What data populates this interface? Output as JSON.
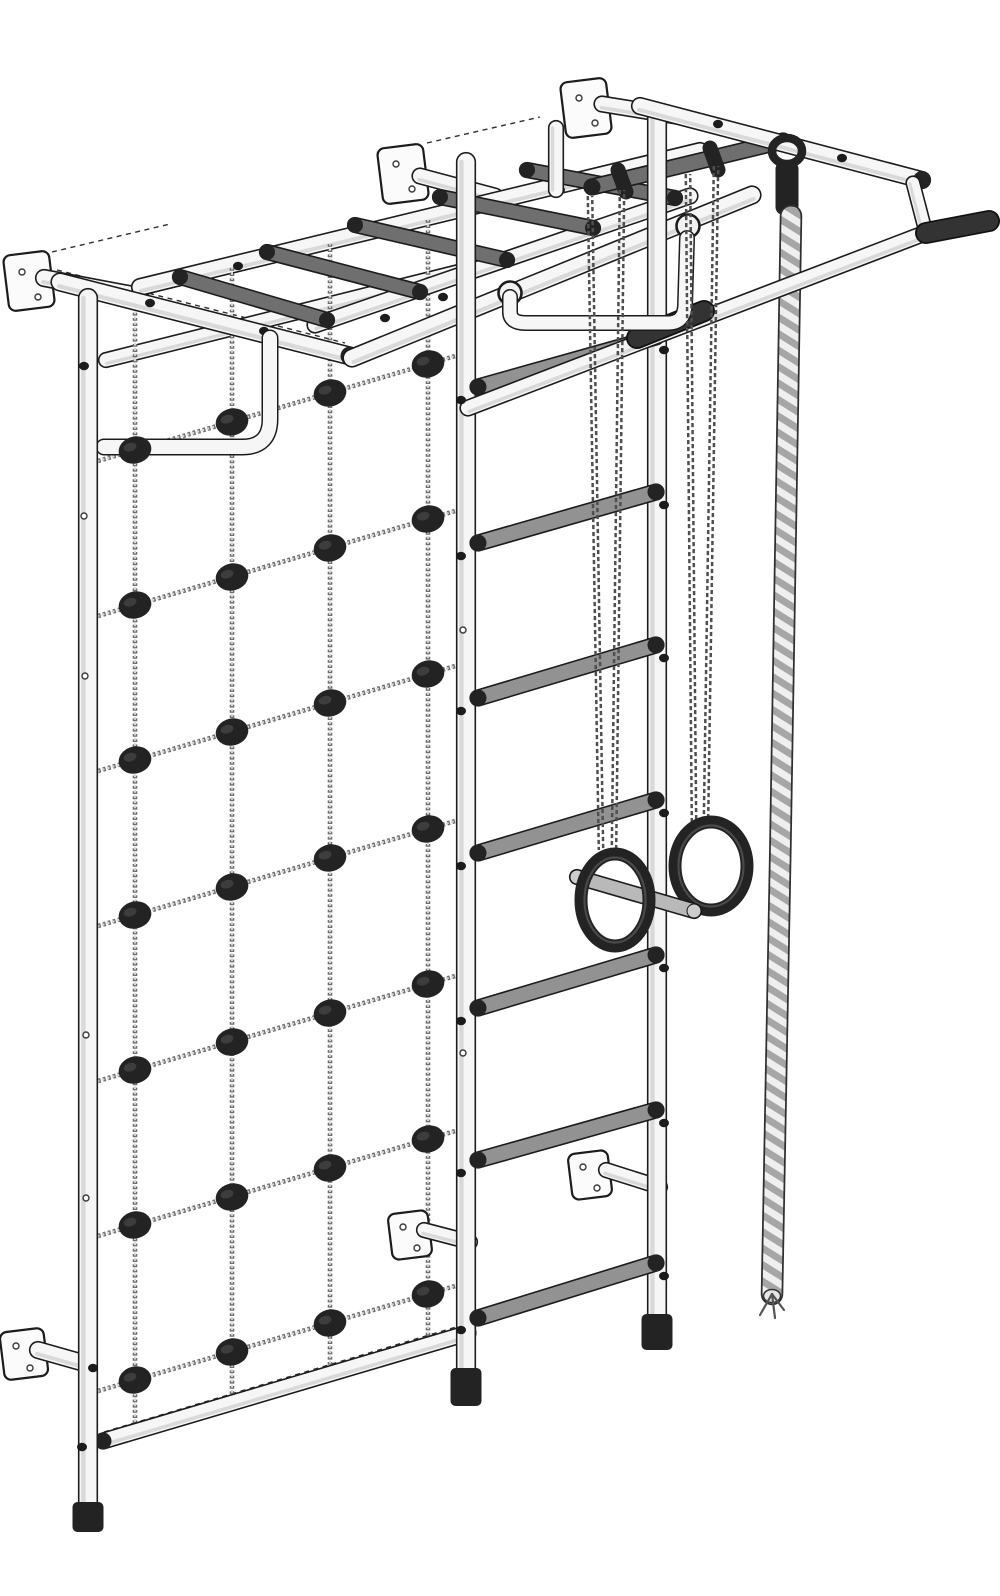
{
  "illustration": {
    "alt_text": "Wall-mounted gym complex: climbing net with black knots, top monkey-bar ladder, wall bars with grey rungs, gymnastic rings with trapeze bar on chains, climbing rope and pull-up bar with black grips, fixed to wall brackets",
    "canvas": {
      "width": 1000,
      "height": 1596,
      "background": "#ffffff"
    },
    "colors": {
      "outline": "#1c1c1c",
      "tube_white": "#f6f6f6",
      "tube_shade": "#d9d9d9",
      "rung_gray": "#929292",
      "rung_dark": "#6f6f6f",
      "bar_light": "#b9b9b9",
      "part_black": "#232323",
      "chain": "#4f4f4f",
      "net_dark": "#6f6f6f",
      "net_light": "#d8d8d8",
      "rope_light": "#efefef",
      "rope_dark": "#a6a6a6"
    },
    "elements": [
      {
        "t": "dash",
        "name": "wall-guide-line",
        "p": [
          52,
          252,
          170,
          224
        ]
      },
      {
        "t": "dash",
        "name": "wall-guide-line",
        "p": [
          427,
          143,
          540,
          117
        ]
      },
      {
        "t": "dash",
        "name": "wall-guide-line",
        "p": [
          608,
          100,
          920,
          172
        ]
      },
      {
        "t": "dash",
        "name": "seam-line",
        "p": [
          140,
          279,
          688,
          147
        ]
      },
      {
        "t": "dash",
        "name": "seam-line",
        "p": [
          57,
          270,
          345,
          343
        ]
      },
      {
        "t": "dash",
        "name": "seam-line",
        "p": [
          352,
          350,
          752,
          188
        ]
      },
      {
        "t": "dash",
        "name": "seam-line",
        "p": [
          470,
          400,
          988,
          212
        ]
      },
      {
        "t": "dash",
        "name": "seam-line",
        "p": [
          104,
          1432,
          466,
          1324
        ]
      },
      {
        "t": "plate",
        "name": "wall-bracket-plate",
        "x": 6,
        "y": 253,
        "w": 46,
        "h": 56,
        "rot": -7,
        "holes": [
          [
            22,
            272
          ],
          [
            38,
            297
          ]
        ]
      },
      {
        "t": "tube",
        "name": "wall-bracket-pin",
        "p": [
          44,
          278,
          140,
          296
        ],
        "w": 15,
        "f": "white"
      },
      {
        "t": "plate",
        "name": "wall-bracket-plate",
        "x": 380,
        "y": 146,
        "w": 46,
        "h": 56,
        "rot": -7,
        "holes": [
          [
            396,
            164
          ],
          [
            412,
            189
          ]
        ]
      },
      {
        "t": "tube",
        "name": "wall-bracket-pin",
        "p": [
          420,
          176,
          495,
          196
        ],
        "w": 14,
        "f": "white"
      },
      {
        "t": "plate",
        "name": "wall-bracket-plate",
        "x": 563,
        "y": 80,
        "w": 46,
        "h": 56,
        "rot": -7,
        "holes": [
          [
            579,
            98
          ],
          [
            595,
            123
          ]
        ]
      },
      {
        "t": "tube",
        "name": "wall-bracket-pin",
        "p": [
          602,
          104,
          682,
          117
        ],
        "w": 14,
        "f": "white"
      },
      {
        "t": "tube",
        "name": "top-ladder-far-rail",
        "p": [
          140,
          287,
          700,
          151
        ],
        "w": 15,
        "f": "white",
        "bolts": [
          [
            238,
            266
          ],
          [
            560,
            190
          ]
        ]
      },
      {
        "t": "tube",
        "name": "net-top-rail",
        "p": [
          106,
          360,
          458,
          272
        ],
        "w": 13,
        "f": "white"
      },
      {
        "t": "netgrid",
        "name": "climbing-net",
        "verticals": [
          [
            135,
            292,
            1430
          ],
          [
            232,
            268,
            1401
          ],
          [
            330,
            244,
            1372
          ],
          [
            428,
            220,
            1344
          ]
        ],
        "hx": [
          98,
          462
        ],
        "horizontals": [
          [
            461,
            354
          ],
          [
            616,
            509
          ],
          [
            771,
            664
          ],
          [
            926,
            819
          ],
          [
            1081,
            974
          ],
          [
            1236,
            1129
          ],
          [
            1391,
            1284
          ]
        ]
      },
      {
        "t": "tube",
        "name": "net-depth-rail",
        "p": [
          60,
          282,
          350,
          356
        ],
        "w": 16,
        "f": "white",
        "caps": [
          null,
          "black"
        ],
        "bolts": [
          [
            150,
            303
          ],
          [
            264,
            331
          ]
        ]
      },
      {
        "t": "tube",
        "name": "top-ladder-near-rail",
        "p": [
          315,
          325,
          690,
          196
        ],
        "w": 14,
        "f": "white",
        "bolts": [
          [
            385,
            318
          ]
        ]
      },
      {
        "t": "tube",
        "name": "front-top-rail",
        "p": [
          352,
          358,
          752,
          195
        ],
        "w": 16,
        "f": "white",
        "bolts": [
          [
            443,
            297
          ]
        ]
      },
      {
        "t": "ptube",
        "name": "hanging-handle-left",
        "d": "M 270 338 L 270 419 Q 270 447 242 447 L 104 447",
        "w": 14,
        "f": "white"
      },
      {
        "t": "knotgrid",
        "name": "net-knots",
        "pts": [
          [
            135,
            450
          ],
          [
            135,
            605
          ],
          [
            135,
            760
          ],
          [
            135,
            915
          ],
          [
            135,
            1070
          ],
          [
            135,
            1225
          ],
          [
            135,
            1380
          ],
          [
            232,
            422
          ],
          [
            232,
            577
          ],
          [
            232,
            732
          ],
          [
            232,
            887
          ],
          [
            232,
            1042
          ],
          [
            232,
            1197
          ],
          [
            232,
            1352
          ],
          [
            330,
            393
          ],
          [
            330,
            548
          ],
          [
            330,
            703
          ],
          [
            330,
            858
          ],
          [
            330,
            1013
          ],
          [
            330,
            1168
          ],
          [
            330,
            1323
          ],
          [
            428,
            364
          ],
          [
            428,
            519
          ],
          [
            428,
            674
          ],
          [
            428,
            829
          ],
          [
            428,
            984
          ],
          [
            428,
            1139
          ],
          [
            428,
            1294
          ]
        ]
      },
      {
        "t": "tube",
        "name": "top-ladder-rung",
        "p": [
          180,
          277,
          327,
          320
        ],
        "w": 13,
        "f": "dgray",
        "caps": [
          "black",
          "black"
        ]
      },
      {
        "t": "tube",
        "name": "top-ladder-rung",
        "p": [
          267,
          252,
          420,
          292
        ],
        "w": 13,
        "f": "dgray",
        "caps": [
          "black",
          "black"
        ]
      },
      {
        "t": "tube",
        "name": "top-ladder-rung",
        "p": [
          355,
          225,
          507,
          260
        ],
        "w": 13,
        "f": "dgray",
        "caps": [
          "black",
          "black"
        ]
      },
      {
        "t": "tube",
        "name": "top-ladder-rung",
        "p": [
          440,
          197,
          593,
          228
        ],
        "w": 13,
        "f": "dgray",
        "caps": [
          "black",
          "black"
        ]
      },
      {
        "t": "tube",
        "name": "top-ladder-rung",
        "p": [
          527,
          170,
          675,
          198
        ],
        "w": 13,
        "f": "dgray",
        "caps": [
          "black",
          "black"
        ]
      },
      {
        "t": "tube",
        "name": "support-stub",
        "p": [
          556,
          128,
          556,
          190
        ],
        "w": 13,
        "f": "white"
      },
      {
        "t": "tube",
        "name": "ring-hanger-bar",
        "p": [
          592,
          187,
          783,
          141
        ],
        "w": 14,
        "f": "dgray",
        "caps": [
          "black",
          null
        ]
      },
      {
        "t": "collar",
        "name": "chain-hook-collar",
        "p": [
          618,
          170,
          626,
          192
        ]
      },
      {
        "t": "collar",
        "name": "chain-hook-collar",
        "p": [
          710,
          148,
          718,
          170
        ]
      },
      {
        "t": "plate",
        "name": "wall-bracket-plate",
        "x": 2,
        "y": 1330,
        "w": 44,
        "h": 48,
        "rot": -7,
        "holes": [
          [
            16,
            1346
          ],
          [
            30,
            1368
          ]
        ]
      },
      {
        "t": "tube",
        "name": "wall-bracket-pin",
        "p": [
          38,
          1350,
          84,
          1363
        ],
        "w": 15,
        "f": "white"
      },
      {
        "t": "plate",
        "name": "wall-bracket-plate",
        "x": 390,
        "y": 1212,
        "w": 40,
        "h": 46,
        "rot": -7,
        "holes": [
          [
            403,
            1227
          ],
          [
            417,
            1248
          ]
        ]
      },
      {
        "t": "tube",
        "name": "wall-bracket-pin",
        "p": [
          424,
          1230,
          470,
          1242
        ],
        "w": 13,
        "f": "white"
      },
      {
        "t": "plate",
        "name": "wall-bracket-plate",
        "x": 570,
        "y": 1152,
        "w": 40,
        "h": 46,
        "rot": -7,
        "holes": [
          [
            583,
            1167
          ],
          [
            597,
            1188
          ]
        ]
      },
      {
        "t": "tube",
        "name": "wall-bracket-pin",
        "p": [
          606,
          1170,
          660,
          1187
        ],
        "w": 13,
        "f": "white"
      },
      {
        "t": "tube",
        "name": "net-bottom-rail",
        "p": [
          103,
          1441,
          468,
          1333
        ],
        "w": 14,
        "f": "white",
        "caps": [
          "black",
          "black"
        ]
      },
      {
        "t": "tube",
        "name": "net-left-post",
        "p": [
          88,
          298,
          88,
          1506
        ],
        "w": 17,
        "f": "white"
      },
      {
        "t": "foot",
        "name": "post-foot",
        "x": 88,
        "y": 1502,
        "w": 31,
        "h": 30
      },
      {
        "t": "tube",
        "name": "wallbars-left-post",
        "p": [
          466,
          162,
          466,
          1372
        ],
        "w": 17,
        "f": "white"
      },
      {
        "t": "foot",
        "name": "post-foot",
        "x": 466,
        "y": 1368,
        "w": 31,
        "h": 38
      },
      {
        "t": "tube",
        "name": "wallbars-right-post",
        "p": [
          657,
          114,
          657,
          1318
        ],
        "w": 17,
        "f": "white"
      },
      {
        "t": "foot",
        "name": "post-foot",
        "x": 657,
        "y": 1314,
        "w": 31,
        "h": 36
      },
      {
        "t": "tube",
        "name": "wallbars-rung",
        "p": [
          478,
          387,
          656,
          337
        ],
        "w": 14,
        "f": "gray",
        "caps": [
          "black",
          "black"
        ]
      },
      {
        "t": "tube",
        "name": "wallbars-rung",
        "p": [
          478,
          543,
          656,
          492
        ],
        "w": 14,
        "f": "gray",
        "caps": [
          "black",
          "black"
        ]
      },
      {
        "t": "tube",
        "name": "wallbars-rung",
        "p": [
          478,
          698,
          656,
          645
        ],
        "w": 14,
        "f": "gray",
        "caps": [
          "black",
          "black"
        ]
      },
      {
        "t": "tube",
        "name": "wallbars-rung",
        "p": [
          478,
          853,
          656,
          800
        ],
        "w": 14,
        "f": "gray",
        "caps": [
          "black",
          "black"
        ]
      },
      {
        "t": "tube",
        "name": "wallbars-rung",
        "p": [
          478,
          1008,
          656,
          955
        ],
        "w": 14,
        "f": "gray",
        "caps": [
          "black",
          "black"
        ]
      },
      {
        "t": "tube",
        "name": "wallbars-rung",
        "p": [
          478,
          1160,
          656,
          1110
        ],
        "w": 14,
        "f": "gray",
        "caps": [
          "black",
          "black"
        ]
      },
      {
        "t": "tube",
        "name": "wallbars-rung",
        "p": [
          478,
          1318,
          656,
          1263
        ],
        "w": 14,
        "f": "gray",
        "caps": [
          "black",
          "black"
        ]
      },
      {
        "t": "tube",
        "name": "pullup-far-rail",
        "p": [
          640,
          106,
          922,
          180
        ],
        "w": 15,
        "f": "white",
        "caps": [
          null,
          "black"
        ],
        "bolts": [
          [
            718,
            124
          ],
          [
            842,
            158
          ]
        ]
      },
      {
        "t": "clamp",
        "name": "rope-clamp",
        "x": 787,
        "y": 151
      },
      {
        "t": "rope",
        "name": "climbing-rope",
        "d": "M 791 216 C 786 520 779 950 772 1294"
      },
      {
        "t": "tube",
        "name": "pullup-drop-tube",
        "p": [
          913,
          183,
          925,
          229
        ],
        "w": 12,
        "f": "white"
      },
      {
        "t": "tube",
        "name": "pullup-bar",
        "p": [
          468,
          408,
          928,
          232
        ],
        "w": 14,
        "f": "white"
      },
      {
        "t": "grip",
        "name": "pullup-grip-left",
        "p": [
          637,
          338,
          704,
          311
        ]
      },
      {
        "t": "grip",
        "name": "pullup-grip-right",
        "p": [
          926,
          233,
          989,
          221
        ]
      },
      {
        "t": "hookring",
        "name": "handle-hook",
        "x": 688,
        "y": 226
      },
      {
        "t": "hookring",
        "name": "handle-hook",
        "x": 510,
        "y": 293
      },
      {
        "t": "ptube",
        "name": "hanging-handle-right",
        "d": "M 510 297 L 510 312 Q 510 323 526 323 L 668 323 Q 684 323 685 306 L 687 238",
        "w": 13,
        "f": "white"
      },
      {
        "t": "chainset",
        "name": "ring-chains",
        "chains": [
          [
            590,
            196,
            601,
            850
          ],
          [
            622,
            190,
            614,
            848
          ],
          [
            688,
            174,
            694,
            822
          ],
          [
            716,
            166,
            706,
            820
          ]
        ]
      },
      {
        "t": "ring",
        "name": "gym-ring-right",
        "x": 711,
        "y": 866,
        "rx": 36,
        "ry": 44
      },
      {
        "t": "tube",
        "name": "trapeze-bar",
        "p": [
          577,
          877,
          694,
          911
        ],
        "w": 13,
        "f": "lgray",
        "caps": [
          "light",
          "light"
        ]
      },
      {
        "t": "ring",
        "name": "gym-ring-left",
        "x": 615,
        "y": 900,
        "rx": 34,
        "ry": 46
      },
      {
        "t": "dots",
        "name": "bolt-dots",
        "pts": [
          [
            84,
            366
          ],
          [
            93,
            1368
          ],
          [
            82,
            1447
          ],
          [
            461,
            400
          ],
          [
            461,
            556
          ],
          [
            461,
            711
          ],
          [
            461,
            866
          ],
          [
            461,
            1021
          ],
          [
            461,
            1173
          ],
          [
            461,
            1330
          ],
          [
            664,
            350
          ],
          [
            664,
            505
          ],
          [
            664,
            658
          ],
          [
            664,
            813
          ],
          [
            664,
            968
          ],
          [
            664,
            1123
          ],
          [
            664,
            1276
          ]
        ]
      },
      {
        "t": "holes",
        "name": "screw-holes",
        "pts": [
          [
            84,
            516
          ],
          [
            85,
            676
          ],
          [
            86,
            1035
          ],
          [
            86,
            1198
          ],
          [
            463,
            630
          ],
          [
            463,
            1053
          ]
        ]
      }
    ]
  }
}
